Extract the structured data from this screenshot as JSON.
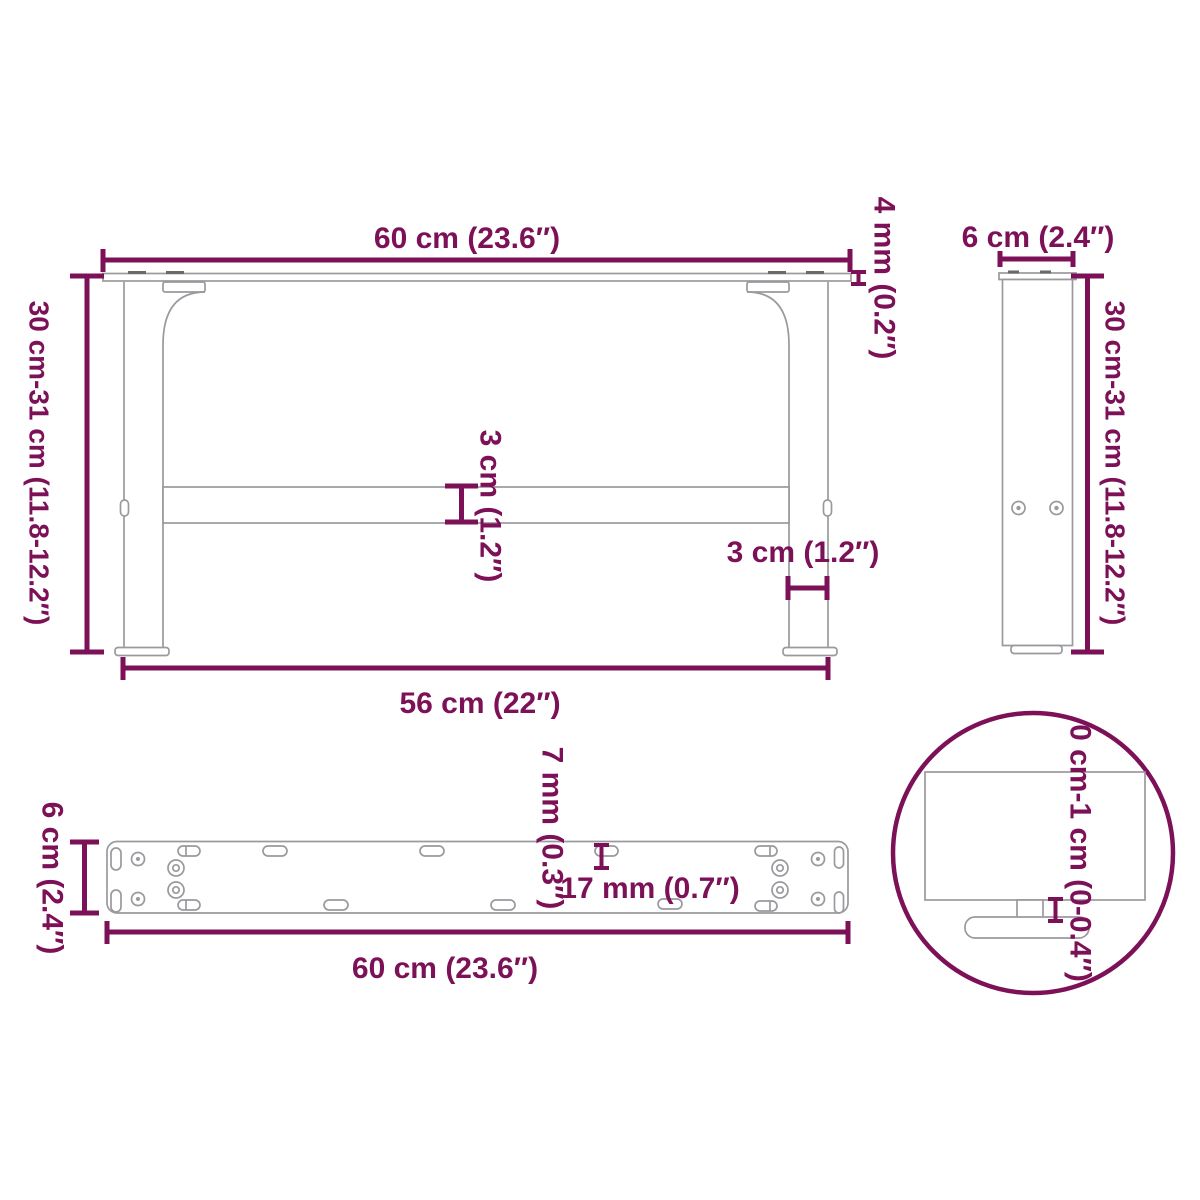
{
  "diagram_title": "table-leg-dimension-diagram",
  "colors": {
    "accent": "#7c1157",
    "outline": "#9a9a9e",
    "background": "#ffffff"
  },
  "front_view": {
    "top_width": "60 cm (23.6″)",
    "height": "30 cm-31 cm (11.8-12.2″)",
    "plate_thickness": "4 mm (0.2″)",
    "crossbar_height": "3 cm (1.2″)",
    "leg_width": "3 cm (1.2″)",
    "bottom_width": "56 cm (22″)"
  },
  "side_view": {
    "width": "6 cm (2.4″)",
    "height": "30 cm-31 cm (11.8-12.2″)"
  },
  "plate_view": {
    "depth": "6 cm (2.4″)",
    "width": "60 cm (23.6″)",
    "hole_diameter": "7 mm (0.3″)",
    "slot_length": "17 mm (0.7″)"
  },
  "detail_view": {
    "adjustable_range": "0 cm-1 cm (0-0.4″)"
  }
}
